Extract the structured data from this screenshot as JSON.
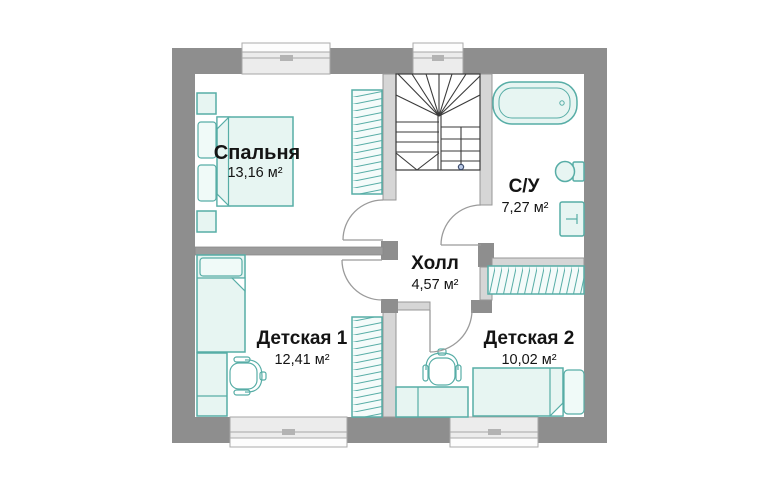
{
  "plan": {
    "rooms": [
      {
        "id": "bedroom",
        "name": "Спальня",
        "area": "13,16 м²"
      },
      {
        "id": "bathroom",
        "name": "С/У",
        "area": "7,27 м²"
      },
      {
        "id": "hall",
        "name": "Холл",
        "area": "4,57 м²"
      },
      {
        "id": "kids1",
        "name": "Детская 1",
        "area": "12,41 м²"
      },
      {
        "id": "kids2",
        "name": "Детская 2",
        "area": "10,02 м²"
      }
    ],
    "fixtures": [
      "staircase",
      "bathtub",
      "toilet",
      "sink-cabinet",
      "double-bed",
      "pillow",
      "nightstand",
      "wardrobe",
      "single-bed",
      "desk",
      "chair",
      "window",
      "door"
    ],
    "colors": {
      "wall": "#8e8e8e",
      "interior_wall": "#d6d6d6",
      "furniture_stroke": "#57ada6",
      "furniture_fill": "#e7f5f2",
      "window_fill": "#ececec",
      "stair_line": "#3a3a3a",
      "text": "#141414",
      "background": "#ffffff"
    }
  }
}
